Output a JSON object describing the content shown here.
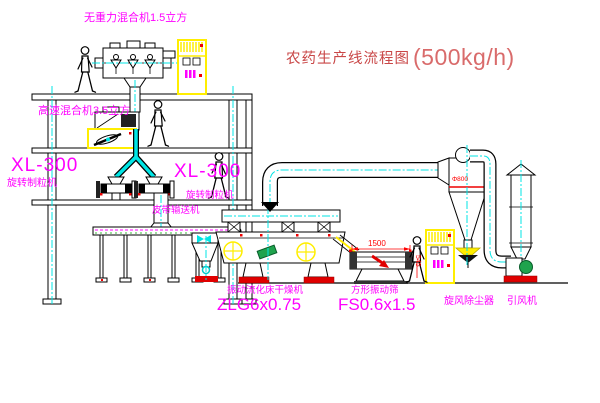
{
  "title": {
    "text": "农药生产线流程图",
    "capacity": "(500kg/h)"
  },
  "equipment": {
    "gravity_mixer": {
      "label": "无重力混合机1.5立方"
    },
    "high_speed_mixer": {
      "label": "高速混合机3.5立方"
    },
    "granulator_left": {
      "model": "XL-300",
      "label": "旋转制粒机"
    },
    "granulator_right": {
      "model": "XL-300",
      "label": "旋转制粒机"
    },
    "belt_conveyor": {
      "label": "皮带输送机"
    },
    "dryer": {
      "label": "振动流化床干燥机",
      "model": "ZLG6x0.75"
    },
    "screen": {
      "label": "方形振动筛",
      "model": "FS0.6x1.5",
      "dim_length": "1500",
      "dim_height": "545"
    },
    "cyclone": {
      "label": "旋风除尘器",
      "dim": "Φ800"
    },
    "fan": {
      "label": "引风机"
    }
  },
  "colors": {
    "label_magenta": "#ff00ff",
    "title_red": "#c94747",
    "dim_red": "#ff0000",
    "centerline_cyan": "#00e5e5",
    "cabinet_yellow": "#ffee00",
    "motor_green": "#1fa34d"
  }
}
